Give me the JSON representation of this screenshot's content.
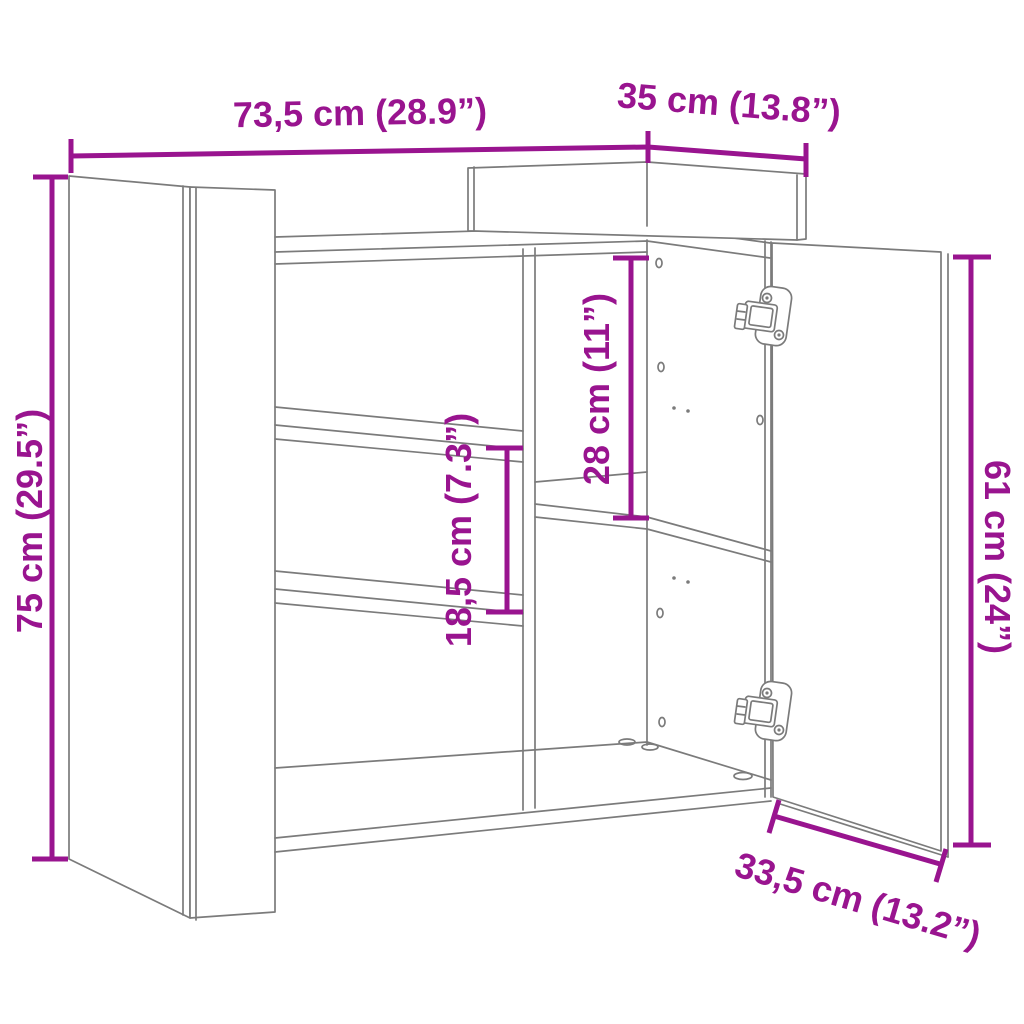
{
  "figure": {
    "title": "Sideboard dimension diagram"
  },
  "colors": {
    "dimension": "#99148F",
    "line": "#7b7b7b",
    "background": "#ffffff"
  },
  "dimensions": {
    "width": {
      "label": "73,5 cm (28.9”)"
    },
    "depth": {
      "label": "35 cm (13.8”)"
    },
    "height": {
      "label": "75 cm (29.5”)"
    },
    "door_height": {
      "label": "61 cm (24”)"
    },
    "compartment": {
      "label": "28 cm (11”)"
    },
    "shelf_spacing": {
      "label": "18,5 cm (7.3”)"
    },
    "door_width": {
      "label": "33,5 cm (13.2”)"
    }
  }
}
